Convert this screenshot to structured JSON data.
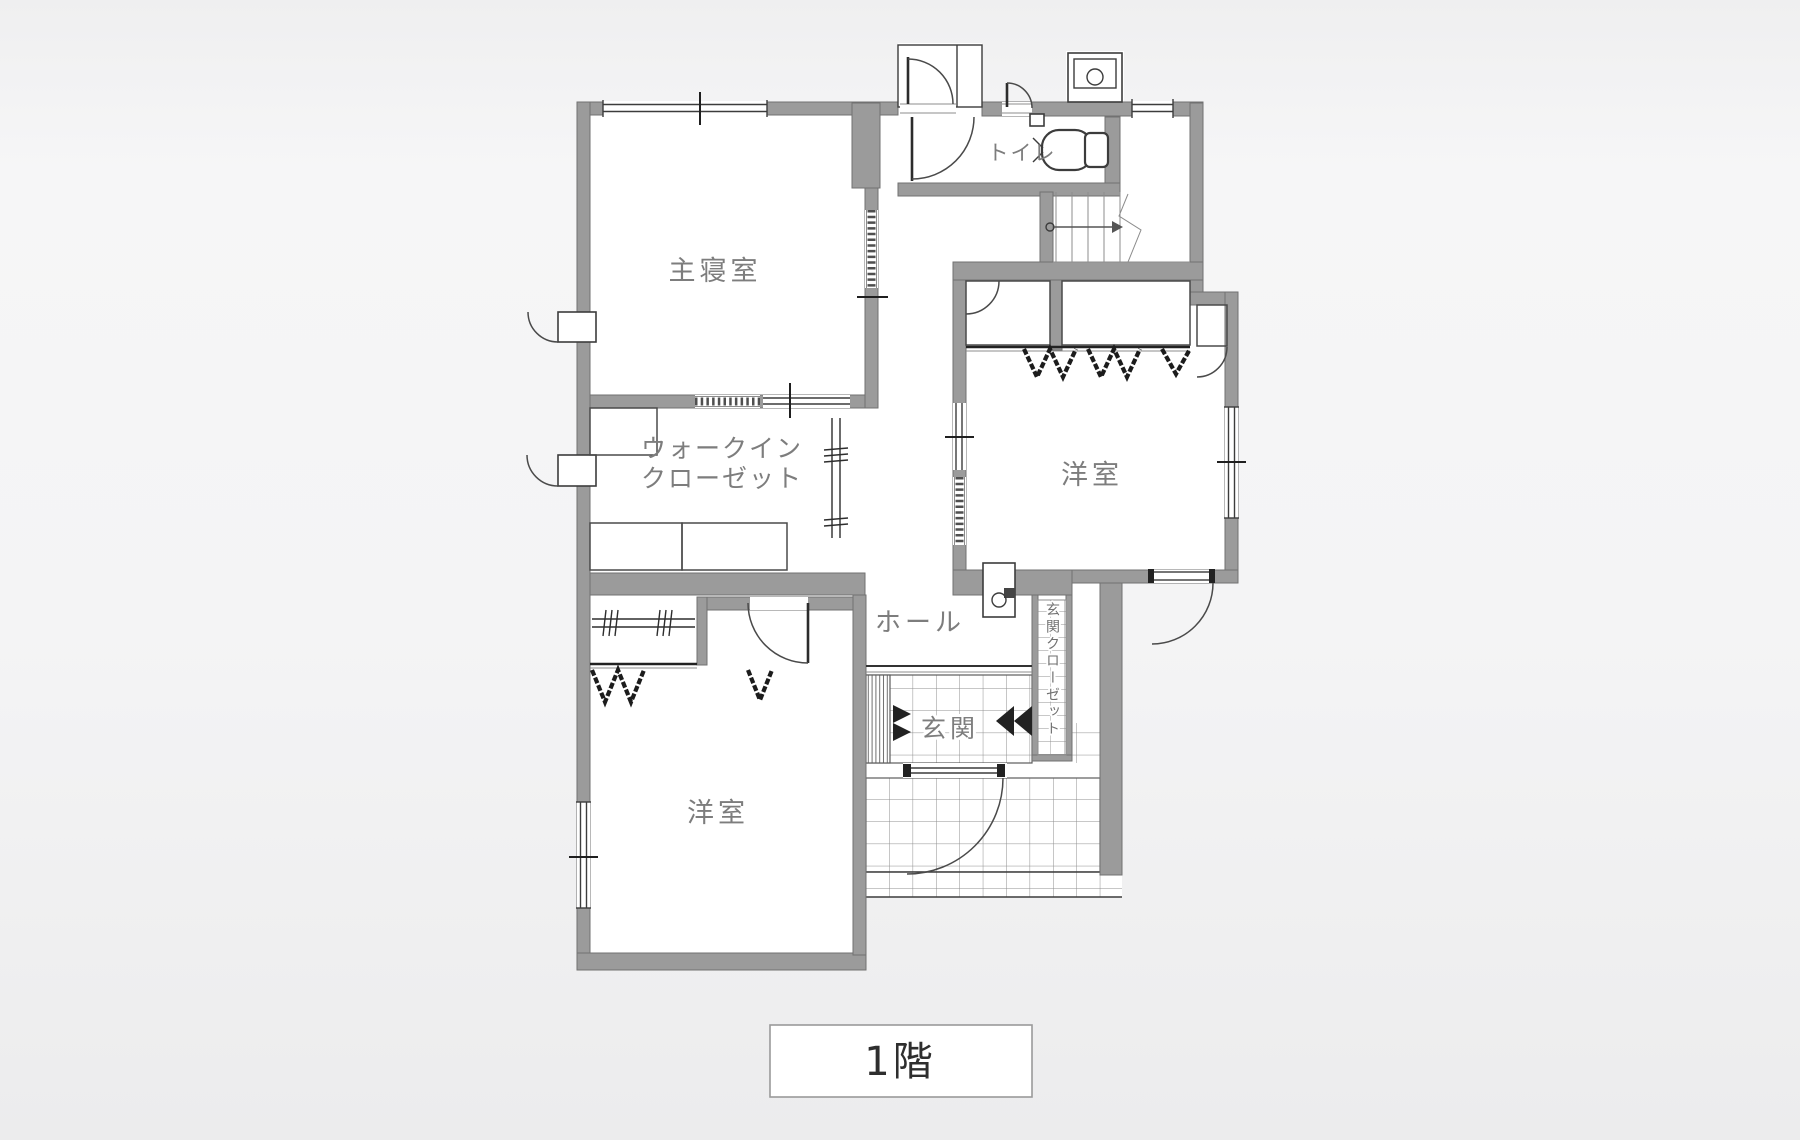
{
  "floor_plan": {
    "labels": {
      "master_bedroom": "主寝室",
      "walk_in_closet_line1": "ウォークイン",
      "walk_in_closet_line2": "クローゼット",
      "western_room_right": "洋室",
      "western_room_bottom": "洋室",
      "hall": "ホール",
      "entrance": "玄関",
      "entrance_closet": "玄関クローゼット",
      "toilet": "トイレ"
    },
    "floor_tag": "1階",
    "colors": {
      "background": "#f2f2f3",
      "paper": "#ffffff",
      "wall": "#9b9b9b",
      "wall_outline": "#717171",
      "line": "#3c3c3c",
      "room_label_text": "#7d7d7d",
      "floor_tag_text": "#2e2e2e"
    }
  }
}
